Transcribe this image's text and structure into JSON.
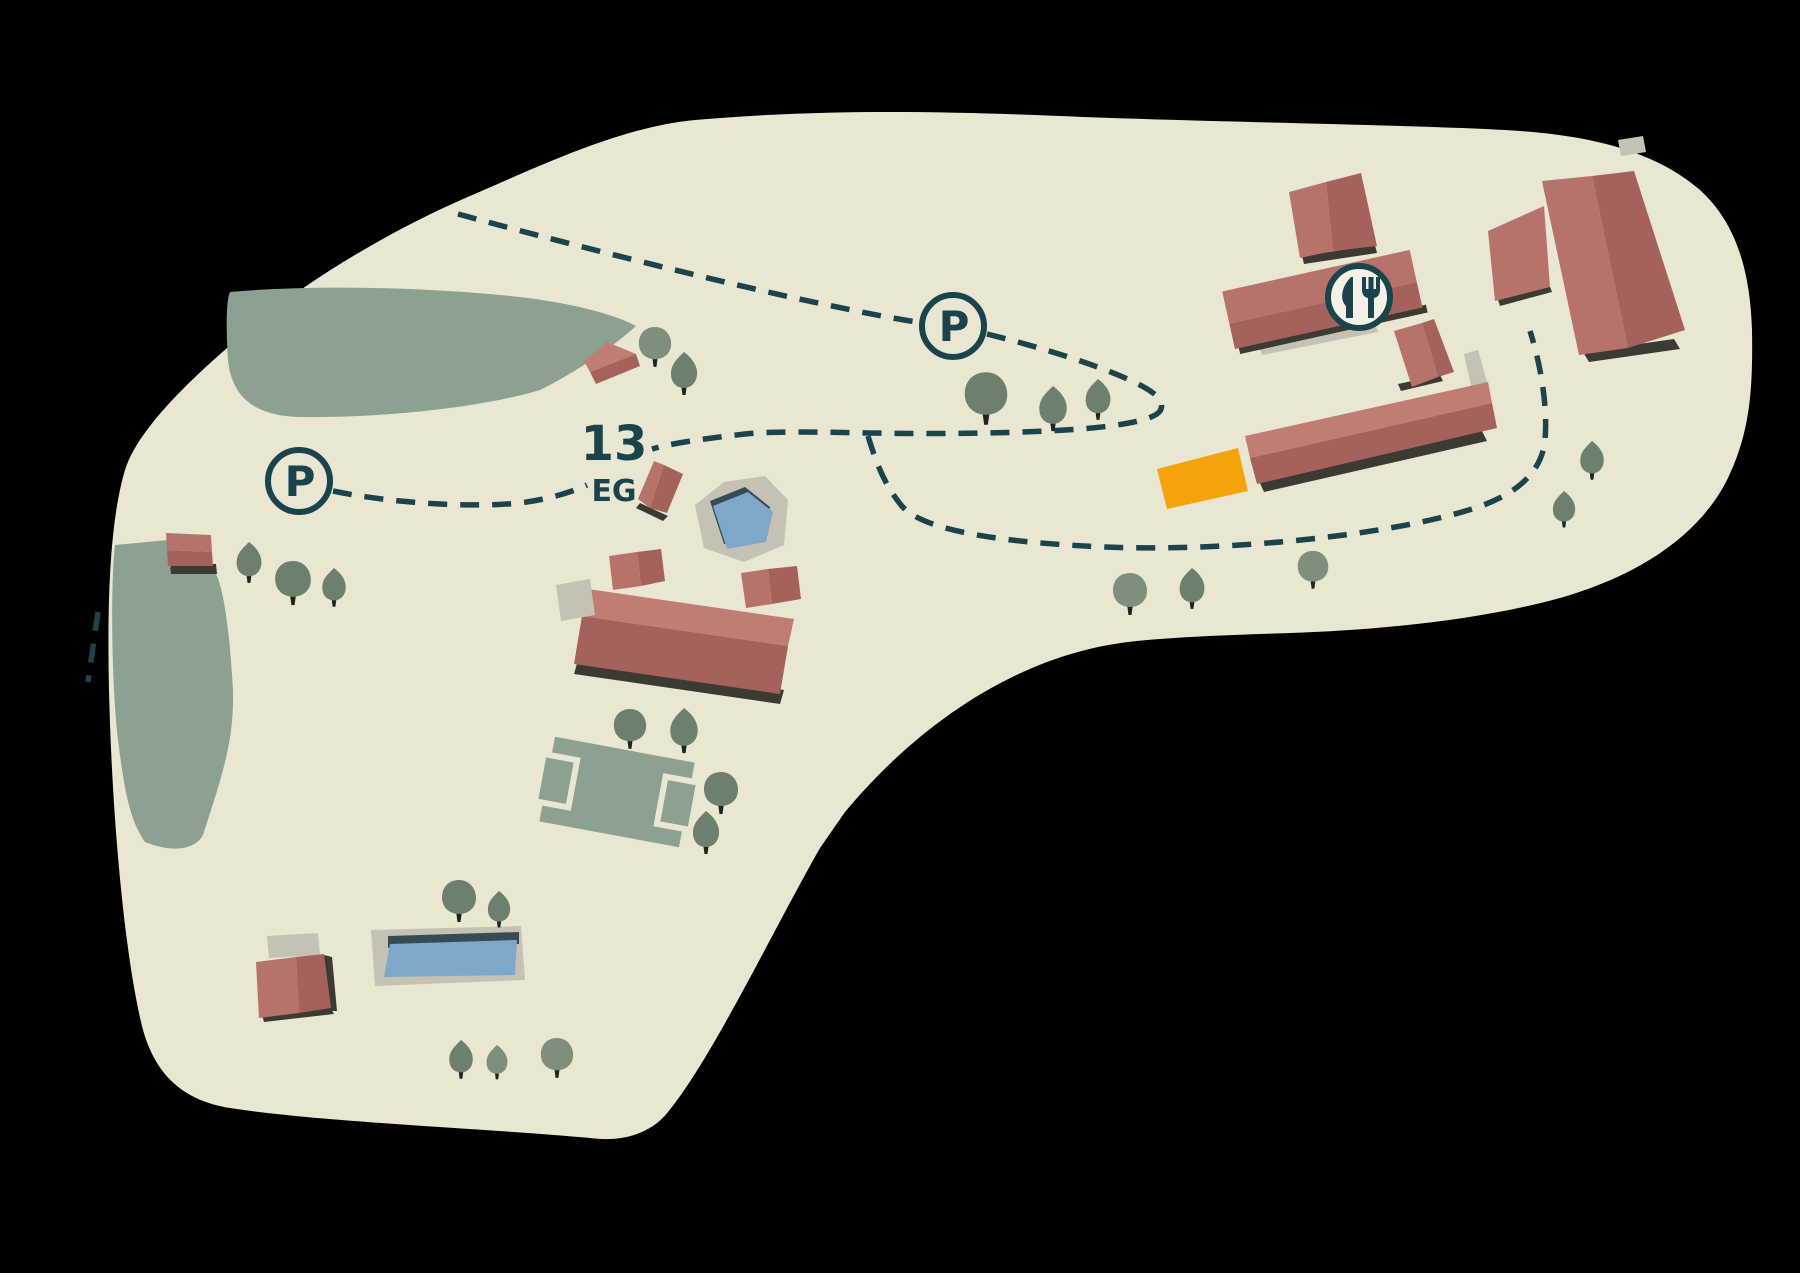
{
  "map": {
    "labels": {
      "building_number": "13",
      "floor_label": "EG"
    },
    "markers": {
      "parking_west_label": "P",
      "parking_north_label": "P",
      "restaurant_icon": "fork-and-knife"
    }
  },
  "palette": {
    "background": "#000000",
    "paper": "#e9e6d2",
    "green": "#8ca192",
    "tree_light": "#7e907b",
    "tree_dark": "#6d806d",
    "trunk": "#1d261c",
    "roof_light": "#b7726b",
    "roof_mid": "#c07d74",
    "roof_dark": "#a5615c",
    "shadow": "#3b3a33",
    "gray": "#c5c2b4",
    "water": "#7ea7c9",
    "water_edge": "#374b55",
    "orange": "#f4a40a",
    "ink": "#1b434b",
    "icon_fill": "#f3f1e5"
  }
}
